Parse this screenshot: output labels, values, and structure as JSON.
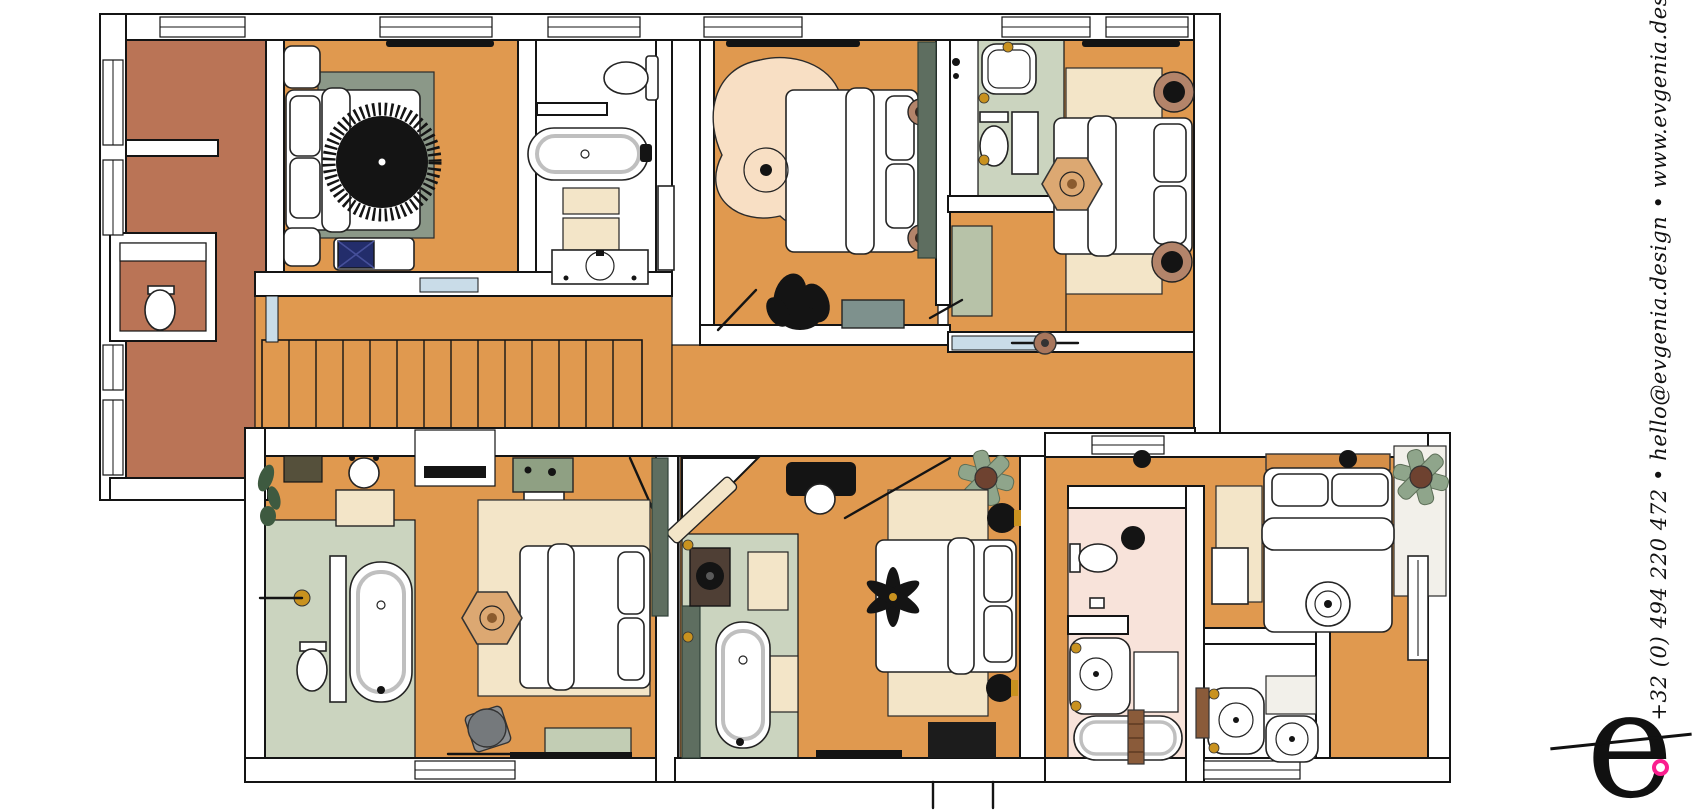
{
  "branding": {
    "contact_text": "+32 (0) 494 220 472 • hello@evgenia.design • www.evgenia.design",
    "logo_letter": "e",
    "logo_accent_color": "#FA1E8E"
  },
  "palette": {
    "floor_orange": "#E0994F",
    "floor_terracotta": "#BA7456",
    "floor_sage": "#CBD4BF",
    "floor_pink": "#F8E3DA",
    "rug_sage": "#8B9888",
    "rug_cream": "#F3E5C8",
    "rug_peach": "#F8DFC4",
    "rug_white": "#F2F0EA",
    "rug_palegreen": "#B7C2A8",
    "wardrobe_green": "#5E6E60",
    "dresser_green": "#8FA083",
    "cabinet_gray_green": "#7E918D",
    "bench_sage": "#C2CDB4",
    "pouf_tan": "#DCA872",
    "wood_brown": "#B3846A",
    "pot_brown": "#6E4230",
    "towel_brown": "#8A5B3A",
    "ottoman_blue": "#232D6B",
    "door_glass": "#C9DCE8",
    "gold": "#C9921F",
    "stool_gray": "#75797C",
    "headboard_orange": "#D68F48",
    "vanity_brown": "#4F3F35",
    "plant_green": "#8FA58B",
    "dark_mat_olive": "#55503B"
  },
  "plan": {
    "rooms": [
      "hallway-landing",
      "wc",
      "bedroom-top-left",
      "bathroom-top-middle",
      "bedroom-top-middle",
      "shower-room-top",
      "bedroom-top-right",
      "staircase-corridor",
      "bedroom-suite-bottom-left",
      "bedroom-suite-bottom-middle",
      "bathroom-bottom-right",
      "bedroom-bottom-right",
      "shower-room-bottom-right"
    ]
  }
}
